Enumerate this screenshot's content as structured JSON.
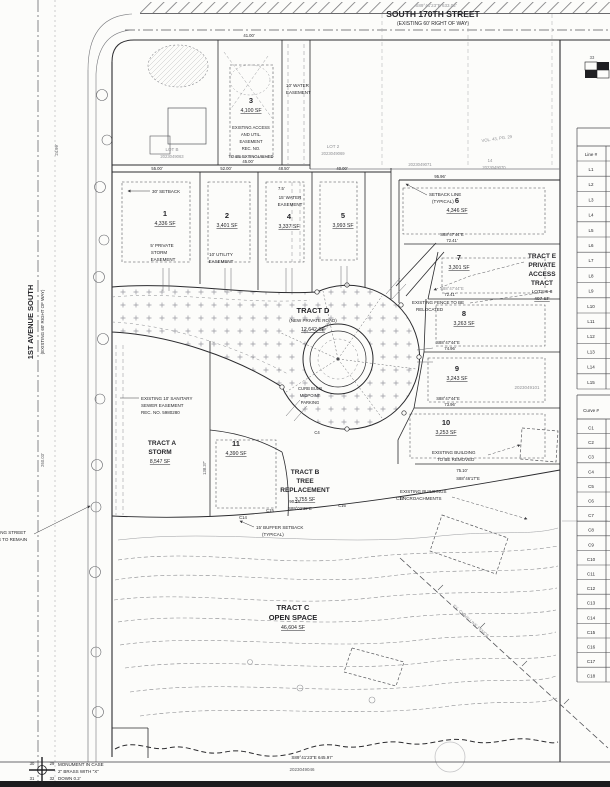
{
  "streets": {
    "top": {
      "bearing": "S89°41'23\"E  633.02'",
      "name": "SOUTH 170TH STREET",
      "row": "(EXISTING 60' RIGHT OF WAY)"
    },
    "left": {
      "name": "1ST AVENUE SOUTH",
      "row": "(EXISTING 60' RIGHT OF WAY)"
    }
  },
  "lots": [
    {
      "num": "1",
      "area": "4,336 SF"
    },
    {
      "num": "2",
      "area": "3,401 SF"
    },
    {
      "num": "3",
      "area": "4,100 SF"
    },
    {
      "num": "4",
      "area": "3,337 SF"
    },
    {
      "num": "5",
      "area": "3,993 SF"
    },
    {
      "num": "6",
      "area": "4,346 SF"
    },
    {
      "num": "7",
      "area": "3,301 SF"
    },
    {
      "num": "8",
      "area": "3,263 SF"
    },
    {
      "num": "9",
      "area": "3,243 SF"
    },
    {
      "num": "10",
      "area": "3,253 SF"
    },
    {
      "num": "11",
      "area": "4,390 SF"
    }
  ],
  "tracts": {
    "a": {
      "l1": "TRACT A",
      "l2": "STORM",
      "area": "8,547 SF"
    },
    "b": {
      "l1": "TRACT B",
      "l2": "TREE",
      "l3": "REPLACEMENT",
      "area": "3,755 SF"
    },
    "c": {
      "l1": "TRACT C",
      "l2": "OPEN SPACE",
      "area": "46,604 SF"
    },
    "d": {
      "l1": "TRACT D",
      "l2": "(NEW PRIVATE ROAD)",
      "area": "12,642 SF"
    },
    "e": {
      "l1": "TRACT E",
      "l2": "PRIVATE",
      "l3": "ACCESS",
      "l4": "TRACT",
      "l5": "LOTS 6-8",
      "area": "407 SF"
    }
  },
  "notes": {
    "setback30": "30' SETBACK",
    "setback_typ": [
      "SETBACK LINE",
      "(TYPICAL)"
    ],
    "water15": [
      "15' WATER",
      "EASEMENT"
    ],
    "water10": [
      "10' WATER",
      "EASEMENT"
    ],
    "util10": [
      "10' UTILITY",
      "EASEMENT"
    ],
    "storm5": [
      "5' PRIVATE",
      "STORM",
      "EASEMENT"
    ],
    "sewer": [
      "EXISTING 10' SANITARY",
      "SEWER EASEMENT",
      "REC. NO. 5980280"
    ],
    "extinguish": [
      "EXISTING ACCESS",
      "AND UTIL.",
      "EASEMENT",
      "REC. NO.",
      "TO BE EXTINGUISHED"
    ],
    "fence": [
      "EXISTING FENCE TO BE",
      "RELOCATED"
    ],
    "removed": [
      "EXISTING BUILDING",
      "TO BE REMOVED"
    ],
    "encroach": [
      "EXISTING BUILDINGS",
      "ENCROACHMENTS"
    ],
    "trees": [
      "EXISTING STREET",
      "TREES TO REMAIN"
    ],
    "buffer": [
      "15' BUFFER SETBACK",
      "(TYPICAL)"
    ],
    "curb": [
      "CURB BULB",
      "MIDPOINT",
      "PARKING"
    ],
    "fence_line": "EX. CHAIN LINK FENCE",
    "offset75": "7.5'"
  },
  "monument": {
    "l1": "MONUMENT IN CASE",
    "l2": "2\" BRASS WITH \"X\"",
    "l3": "DOWN 0.2'",
    "sec": [
      "30",
      "29",
      "31",
      "32"
    ]
  },
  "parcels": {
    "lotb": [
      "LOT B",
      "2023049063"
    ],
    "lot2": [
      "LOT 2",
      "2023049069"
    ],
    "p071": "2023049071",
    "p070a": "14",
    "p070b": "2023049070",
    "vol": "VOL. 43, PG. 29",
    "east": "2023049101",
    "south": "2023049046",
    "south_bearing": "S89°41'23\"E  645.97'"
  },
  "dims": {
    "d41": "41.00'",
    "d45": "45.00'",
    "d55": "55.00'",
    "d52": "52.00'",
    "d485": "48.50'",
    "d40": "40.00'",
    "d9596": "95.96'",
    "d7241": "72.41'",
    "d7496": "74.96'",
    "d7396": "73.96'",
    "d7510": "75.10'",
    "d9014": "90.14'",
    "d2499": "24.99'",
    "d26003": "260.03'",
    "d13837": "138.37'",
    "d4550": "45.50'"
  },
  "bearings": {
    "b8847": "S88°47'44\"E",
    "b8846": "S88°46'17\"E",
    "b8902": "S89°02'39\"E"
  },
  "curve_labels": {
    "c4": "C4",
    "c14": "C14",
    "c15": "C15",
    "c16": "C16",
    "c17": "C17"
  },
  "tables": {
    "line": {
      "header": "Line #",
      "rows": [
        "L1",
        "L2",
        "L3",
        "L4",
        "L5",
        "L6",
        "L7",
        "L8",
        "L9",
        "L10",
        "L11",
        "L12",
        "L13",
        "L14",
        "L15"
      ]
    },
    "curve": {
      "header": "Curve #",
      "rows": [
        "C1",
        "C2",
        "C3",
        "C4",
        "C5",
        "C6",
        "C7",
        "C8",
        "C9",
        "C10",
        "C11",
        "C12",
        "C13",
        "C14",
        "C15",
        "C16",
        "C17",
        "C18"
      ]
    }
  },
  "compass": "33"
}
